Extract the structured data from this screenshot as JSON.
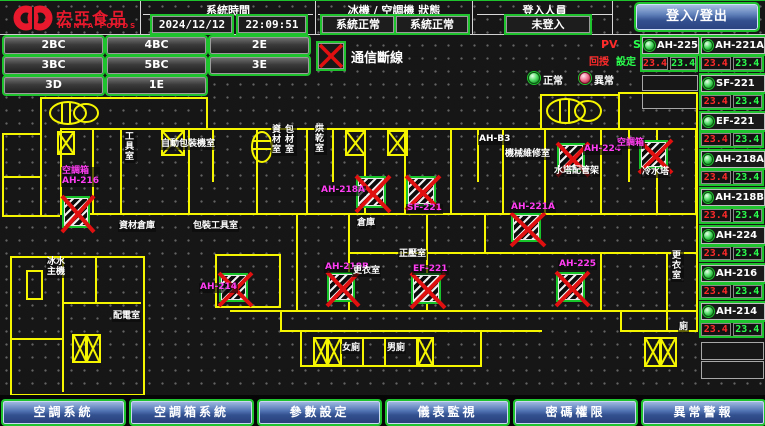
{
  "header": {
    "brand": {
      "name": "宏亞食品",
      "name_en": "HUNYA FOODS"
    },
    "system_time": {
      "label": "系統時間",
      "date": "2024/12/12",
      "time": "22:09:51"
    },
    "status": {
      "label": "冰機 / 空調機 狀態",
      "chiller": "系統正常",
      "ahu": "系統正常"
    },
    "login": {
      "label": "登入人員",
      "user": "未登入",
      "button": "登入/登出"
    }
  },
  "floor_buttons": [
    "2BC",
    "4BC",
    "2E",
    "3BC",
    "5BC",
    "3E",
    "3D",
    "1E"
  ],
  "legend": {
    "comm_loss": "通信斷線",
    "normal": "正常",
    "abnormal": "異常",
    "pv": "PV",
    "sv": "SV",
    "pv_name": "回授",
    "sv_name": "設定"
  },
  "units": [
    {
      "name": "AH-225",
      "pv": "23.4",
      "sv": "23.4"
    },
    {
      "name": "AH-221A",
      "pv": "23.4",
      "sv": "23.4"
    },
    {
      "name": "SF-221",
      "pv": "23.4",
      "sv": "23.4"
    },
    {
      "name": "EF-221",
      "pv": "23.4",
      "sv": "23.4"
    },
    {
      "name": "AH-218A",
      "pv": "23.4",
      "sv": "23.4"
    },
    {
      "name": "AH-218B",
      "pv": "23.4",
      "sv": "23.4"
    },
    {
      "name": "AH-224",
      "pv": "23.4",
      "sv": "23.4"
    },
    {
      "name": "AH-216",
      "pv": "23.4",
      "sv": "23.4"
    },
    {
      "name": "AH-214",
      "pv": "23.4",
      "sv": "23.4"
    }
  ],
  "floorplan": {
    "unit_labels": {
      "u1a": "空調箱",
      "u1b": "AH-216",
      "u2": "AH-218A",
      "u3": "SF-221",
      "u4": "AH-221A",
      "u5": "AH-224",
      "u6": "空調箱",
      "u7": "AH-214",
      "u8": "AH-218B",
      "u9": "EF-221",
      "u10": "AH-225"
    },
    "rooms": {
      "tool": "工具室",
      "auto_pack": "自動包裝機室",
      "material": "資材室",
      "pack_mat": "包材室",
      "dry": "烘乾室",
      "ah_b3": "AH-B3",
      "maint": "機械維修室",
      "tower_pipe": "水塔配管架",
      "cool_tower": "冷水塔",
      "mat_store": "資材倉庫",
      "pack_tool": "包裝工具室",
      "store": "倉庫",
      "dress1": "更衣室",
      "pressure": "正壓室",
      "w_wc": "女廁",
      "m_wc": "男廁",
      "wc": "廁",
      "dress2": "更衣室",
      "chiller": "冰水主機",
      "elec": "配電室"
    }
  },
  "nav": [
    "空調系統",
    "空調箱系統",
    "參數設定",
    "儀表監視",
    "密碼權限",
    "異常警報"
  ],
  "colors": {
    "brand_red": "#e8192c",
    "line_yellow": "#f5f500",
    "ok_green": "#1ec32e",
    "alarm_red": "#e01010",
    "label_magenta": "#ff3df2",
    "pv_red": "#ff2a2a",
    "sv_green": "#2aff4d",
    "button_blue": "#33508f"
  }
}
